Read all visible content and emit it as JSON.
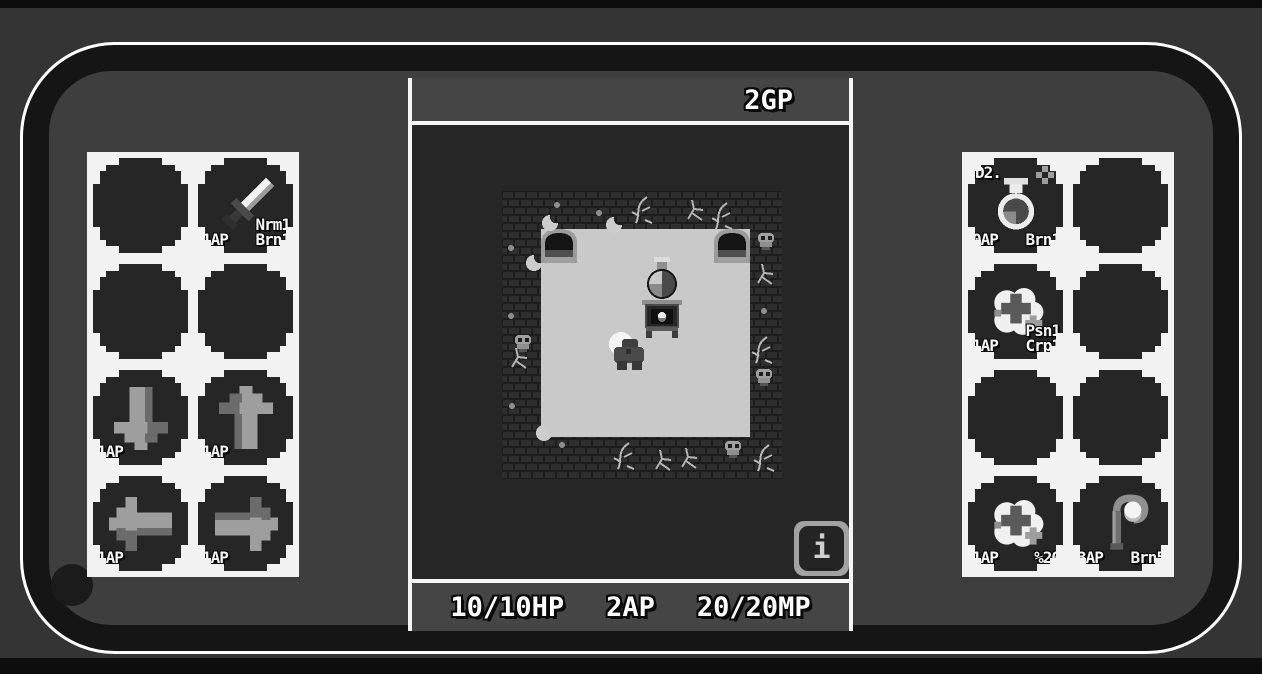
{
  "colors": {
    "background": "#343434",
    "bezel": "#151515",
    "screen": "#3e3e3e",
    "panel_bg": "#f2f2f2",
    "slot_bg": "#262626",
    "bar_bg": "#454545",
    "game_bg": "#262626",
    "floor": "#c9c9c9",
    "text": "#ffffff"
  },
  "top_bar": {
    "gold": "2GP"
  },
  "bottom_bar": {
    "hp": "10/10HP",
    "ap": "2AP",
    "mp": "20/20MP"
  },
  "info_button": {
    "label": "i",
    "icon": "info-icon"
  },
  "left_panel": {
    "slots": [
      {
        "empty": true
      },
      {
        "icon": "sword-icon",
        "label_bl": "1AP",
        "label_br": [
          "Nrm1",
          "Brn1"
        ]
      },
      {
        "empty": true
      },
      {
        "empty": true
      },
      {
        "icon": "arrow-down-icon",
        "label_bl": "1AP"
      },
      {
        "icon": "arrow-up-icon",
        "label_bl": "1AP"
      },
      {
        "icon": "arrow-left-icon",
        "label_bl": "1AP"
      },
      {
        "icon": "arrow-right-icon",
        "label_bl": "1AP"
      }
    ]
  },
  "right_panel": {
    "slots": [
      {
        "icon": "potion-icon",
        "label_tl": "D2.",
        "icon_tr": "sparkle-icon",
        "label_bl": "0AP",
        "label_br": [
          "Brn1"
        ]
      },
      {
        "empty": true
      },
      {
        "icon": "heal-cloud-icon",
        "label_bl": "1AP",
        "label_br": [
          "Psn1",
          "Crp1"
        ]
      },
      {
        "empty": true
      },
      {
        "empty": true
      },
      {
        "empty": true
      },
      {
        "icon": "heal-cloud-icon",
        "label_bl": "1AP",
        "label_br": [
          "%20"
        ]
      },
      {
        "icon": "staff-icon",
        "label_bl": "3AP",
        "label_br": [
          "Brn5"
        ]
      }
    ]
  },
  "game_view": {
    "entities": [
      "brick-wall",
      "room-floor",
      "arch-left",
      "arch-right",
      "potion-pedestal",
      "player-character",
      "skull-decoration",
      "vine-decoration"
    ]
  }
}
